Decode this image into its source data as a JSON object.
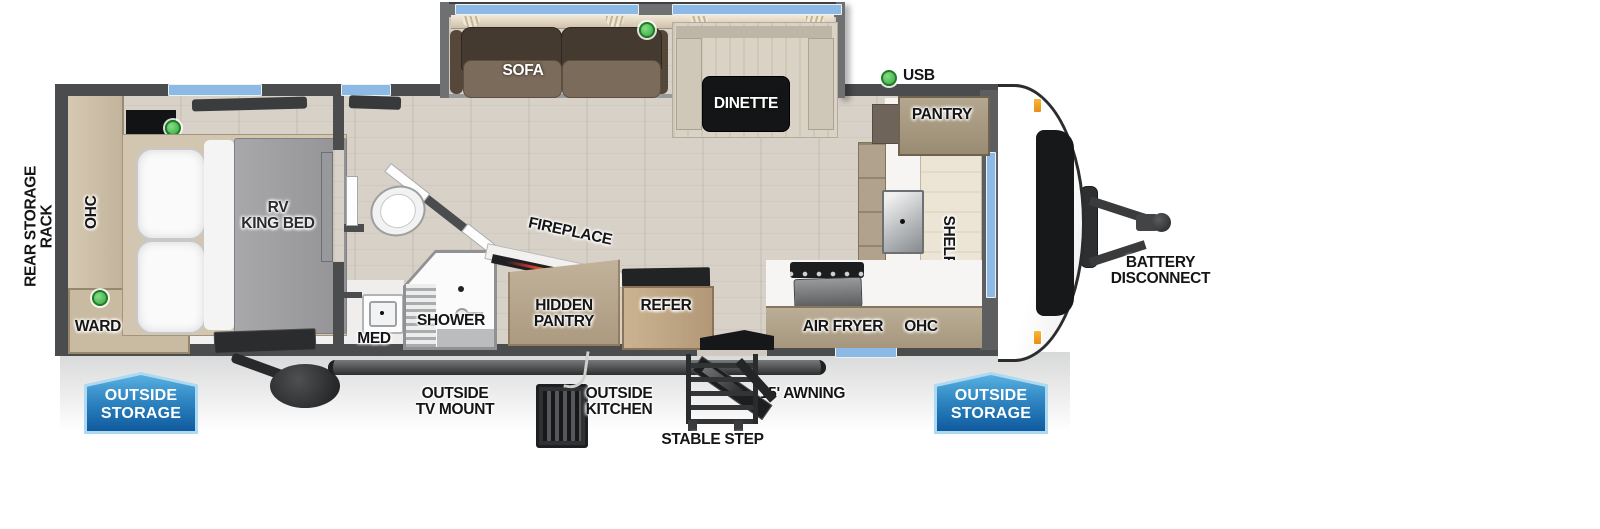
{
  "colors": {
    "wall_gray": "#4b4c4e",
    "window_blue": "#8cbae7",
    "indicator_green": "#3fb44a",
    "badge_blue_light": "#58b0e0",
    "badge_blue_dark": "#0f5a9e",
    "floor_wood": "#d8d1c8",
    "sofa_brown": "#453a2f",
    "marker_orange": "#f0a224"
  },
  "labels": {
    "rear_storage_rack": "REAR STORAGE RACK",
    "bedroom_ohc": "OHC",
    "rv_king_bed": "RV\nKING BED",
    "ward": "WARD",
    "sofa": "SOFA",
    "dinette": "DINETTE",
    "usb": "USB",
    "pantry": "PANTRY",
    "shelf": "SHELF",
    "air_fryer": "AIR FRYER",
    "kitchen_ohc": "OHC",
    "battery_disconnect": "BATTERY\nDISCONNECT",
    "med": "MED",
    "shower": "SHOWER",
    "fireplace": "FIREPLACE",
    "hidden_pantry": "HIDDEN\nPANTRY",
    "refer": "REFER",
    "outside_storage": "OUTSIDE\nSTORAGE",
    "outside_tv_mount": "OUTSIDE\nTV MOUNT",
    "outside_kitchen": "OUTSIDE\nKITCHEN",
    "stable_step": "STABLE STEP",
    "awning": "15' AWNING"
  }
}
